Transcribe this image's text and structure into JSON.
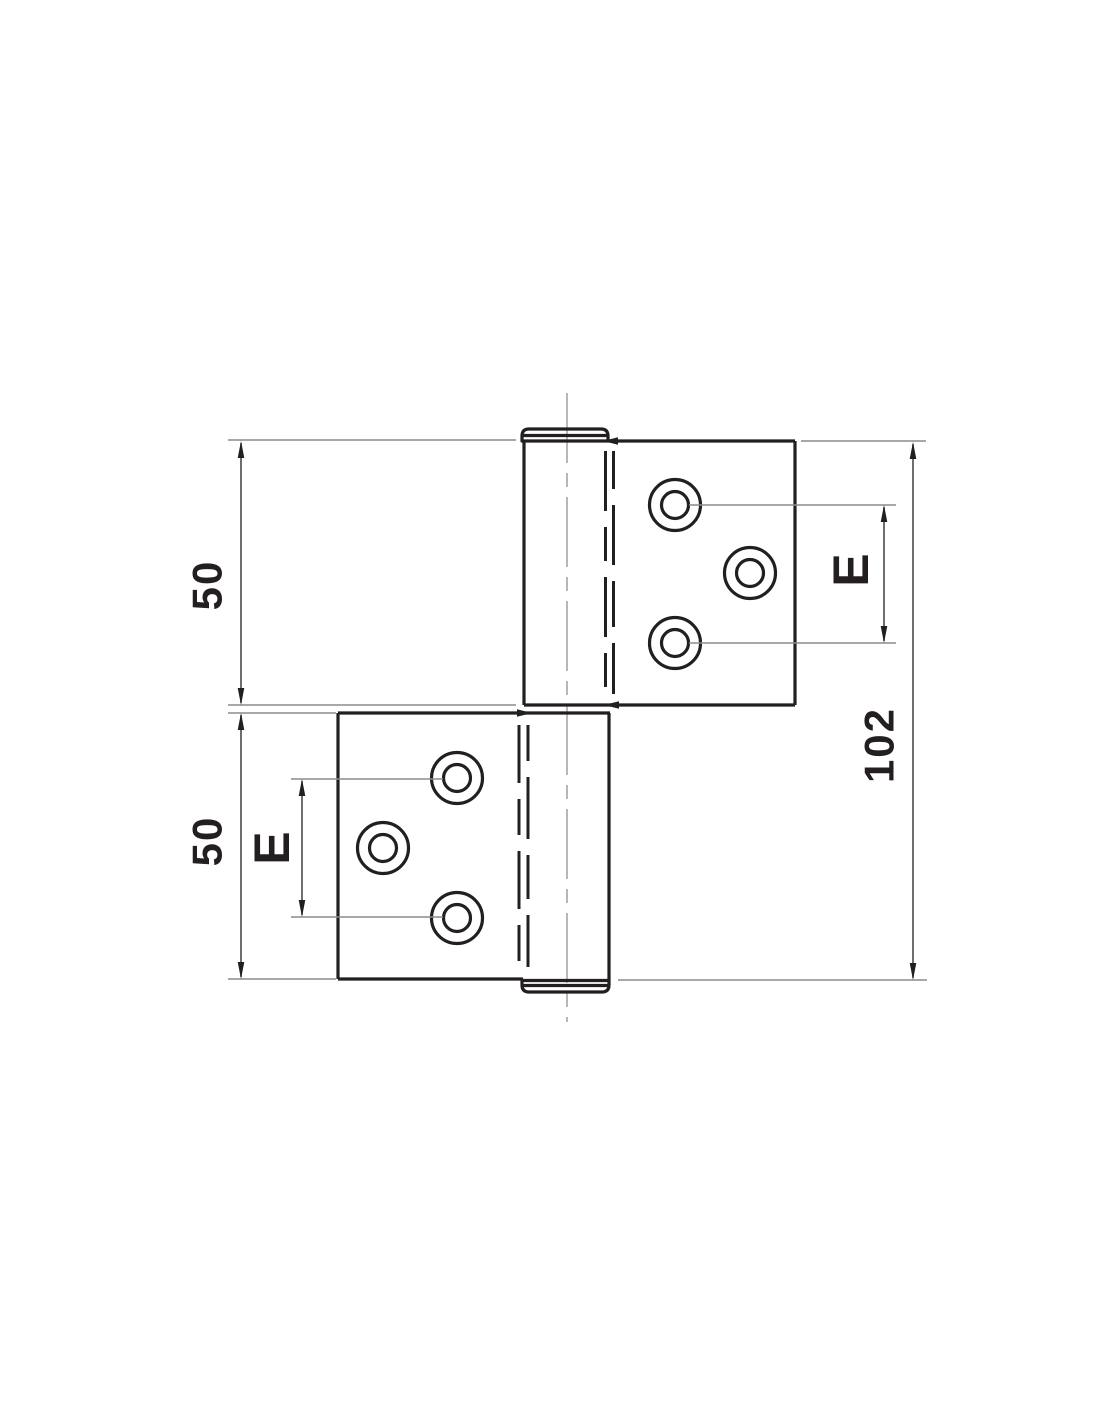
{
  "drawing": {
    "type": "technical-drawing",
    "subject": "two-leaf lift-off hinge, front elevation with dimensions",
    "labels": {
      "top_leaf_height": "50",
      "bottom_leaf_height": "50",
      "total_height": "102",
      "hole_spacing_top": "E",
      "hole_spacing_bottom": "E"
    },
    "colors": {
      "background": "#ffffff",
      "outline": "#231f20",
      "thin_line": "#8c8c8c",
      "dim_line": "#4a4a4a",
      "center_line": "#9a9a9a"
    }
  }
}
